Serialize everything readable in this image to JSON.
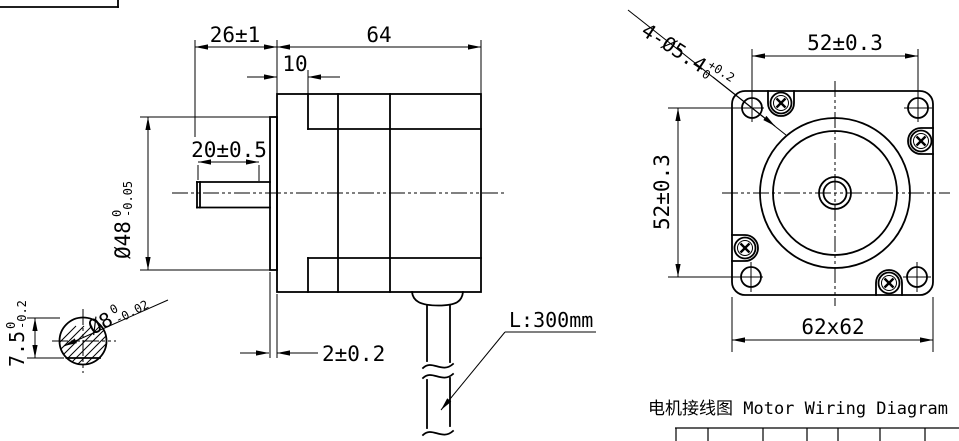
{
  "drawing": {
    "side_view": {
      "dim_shaft_total": "26±1",
      "dim_body_length": "64",
      "dim_pilot_depth": "10",
      "dim_shaft_length": "20±0.5",
      "dim_pilot_dia": {
        "value": "Ø48",
        "tol_upper": "0",
        "tol_lower": "-0.05"
      },
      "dim_boss_height": "2±0.2",
      "cable_label": "L:300mm"
    },
    "shaft_section": {
      "dim_shaft_dia": {
        "value": "Ø8",
        "tol_upper": "0",
        "tol_lower": "-0.02"
      },
      "dim_flat": {
        "value": "7.5",
        "tol_upper": "0",
        "tol_lower": "-0.2"
      }
    },
    "front_view": {
      "dim_mounting_holes": {
        "value": "4-Ø5.4",
        "tol_upper": "+0.2",
        "tol_lower": "0"
      },
      "dim_hole_spacing_h": "52±0.3",
      "dim_hole_spacing_v": "52±0.3",
      "dim_flange": "62x62"
    },
    "wiring_section": {
      "title": "电机接线图 Motor Wiring Diagram"
    }
  }
}
